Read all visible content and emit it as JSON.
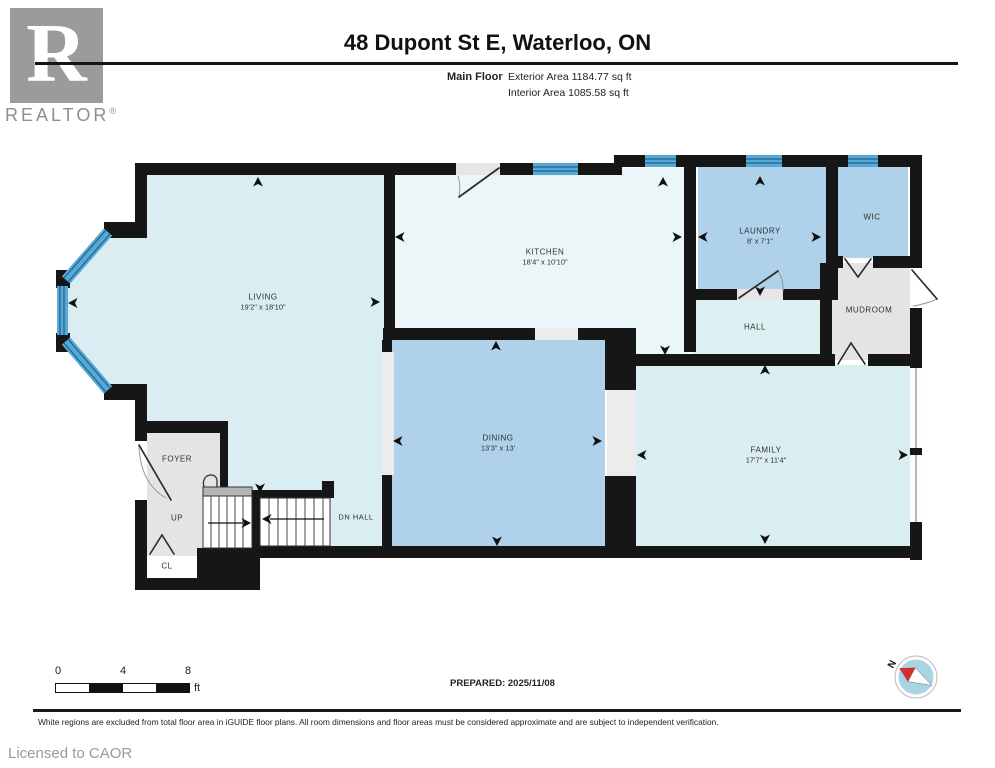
{
  "header": {
    "brand": "REALTOR",
    "brand_initial": "R",
    "registered": "®",
    "title": "48 Dupont St E, Waterloo, ON",
    "floor_label": "Main Floor",
    "exterior_area": "Exterior Area 1184.77 sq ft",
    "interior_area": "Interior Area 1085.58 sq ft"
  },
  "rooms": {
    "living": {
      "name": "LIVING",
      "dims": "19'2\" x 18'10\""
    },
    "kitchen": {
      "name": "KITCHEN",
      "dims": "18'4\" x 10'10\""
    },
    "laundry": {
      "name": "LAUNDRY",
      "dims": "8' x 7'1\""
    },
    "wic": {
      "name": "WIC"
    },
    "mudroom": {
      "name": "MUDROOM"
    },
    "hall": {
      "name": "HALL"
    },
    "dining": {
      "name": "DINING",
      "dims": "13'3\" x 13'"
    },
    "family": {
      "name": "FAMILY",
      "dims": "17'7\" x 11'4\""
    },
    "foyer": {
      "name": "FOYER"
    },
    "up": {
      "name": "UP"
    },
    "dn_hall": {
      "name": "DN HALL"
    },
    "cl": {
      "name": "CL"
    }
  },
  "scale_bar": {
    "tick0": "0",
    "tick1": "4",
    "tick2": "8",
    "unit": "ft"
  },
  "prepared": "PREPARED: 2025/11/08",
  "compass": {
    "label": "N"
  },
  "footer": {
    "disclaimer": "White regions are excluded from total floor area in iGUIDE floor plans. All room dimensions and floor areas must be considered approximate and are subject to independent verification.",
    "license": "Licensed to CAOR"
  },
  "colors": {
    "wall": "#161616",
    "room_light_cyan": "#d9edf2",
    "room_kitchen": "#eaf6f8",
    "room_medium_blue": "#afd1e9",
    "room_gray": "#e4e4e5",
    "window_blue": "#57a8d5",
    "window_stripe": "#1d6390",
    "compass_red": "#d32f2f"
  }
}
